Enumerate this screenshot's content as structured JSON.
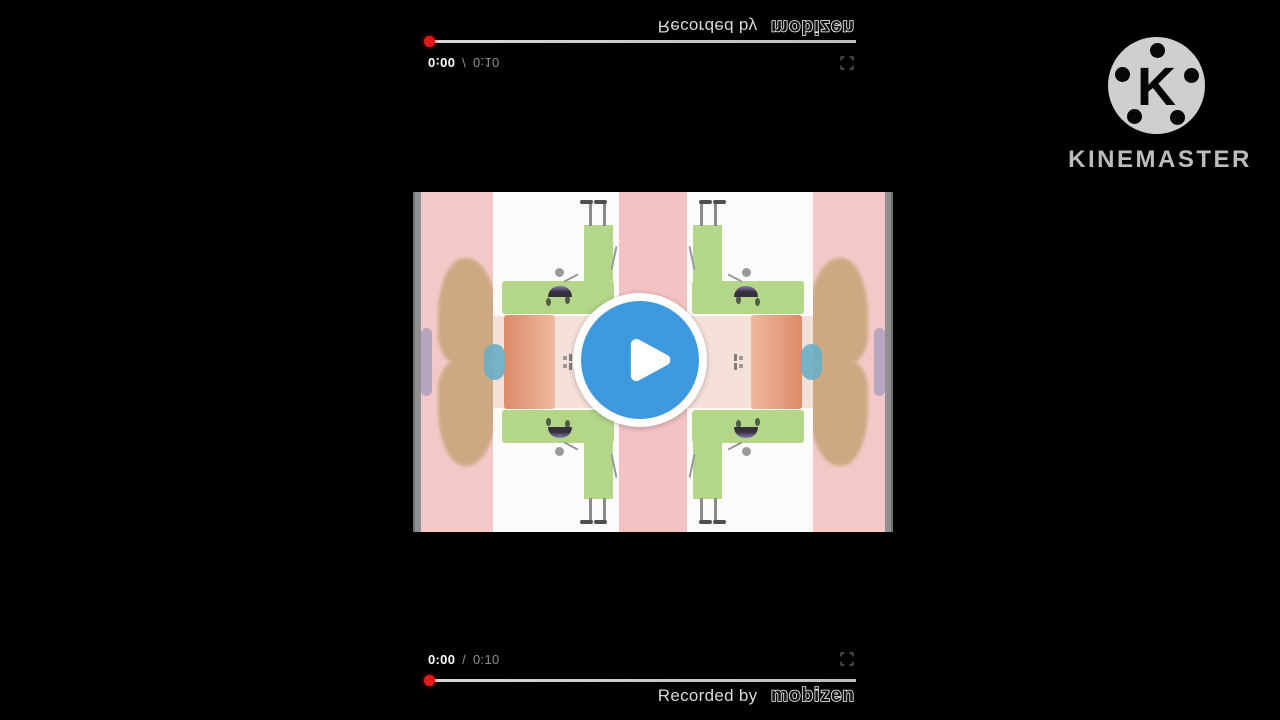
{
  "video_player": {
    "current_time": "0:00",
    "separator": "/",
    "duration": "0:10",
    "recorded_by_text": "Recorded by",
    "recorder_brand": "mobizen",
    "progress_fraction": 0
  },
  "kinemaster_watermark": {
    "logo_letter": "K",
    "brand_name": "KINEMASTER"
  },
  "icons": {
    "play": "play-triangle",
    "fullscreen": "fullscreen-corner-brackets",
    "progress_handle": "red-record-dot",
    "kinemaster": "film-reel-k-logo"
  },
  "colors": {
    "background": "#000000",
    "play_button_blue": "#3d9ade",
    "progress_dot_red": "#e11b1b",
    "video_bg_pink": "#f5c8c8",
    "character_green": "#b3d689"
  }
}
